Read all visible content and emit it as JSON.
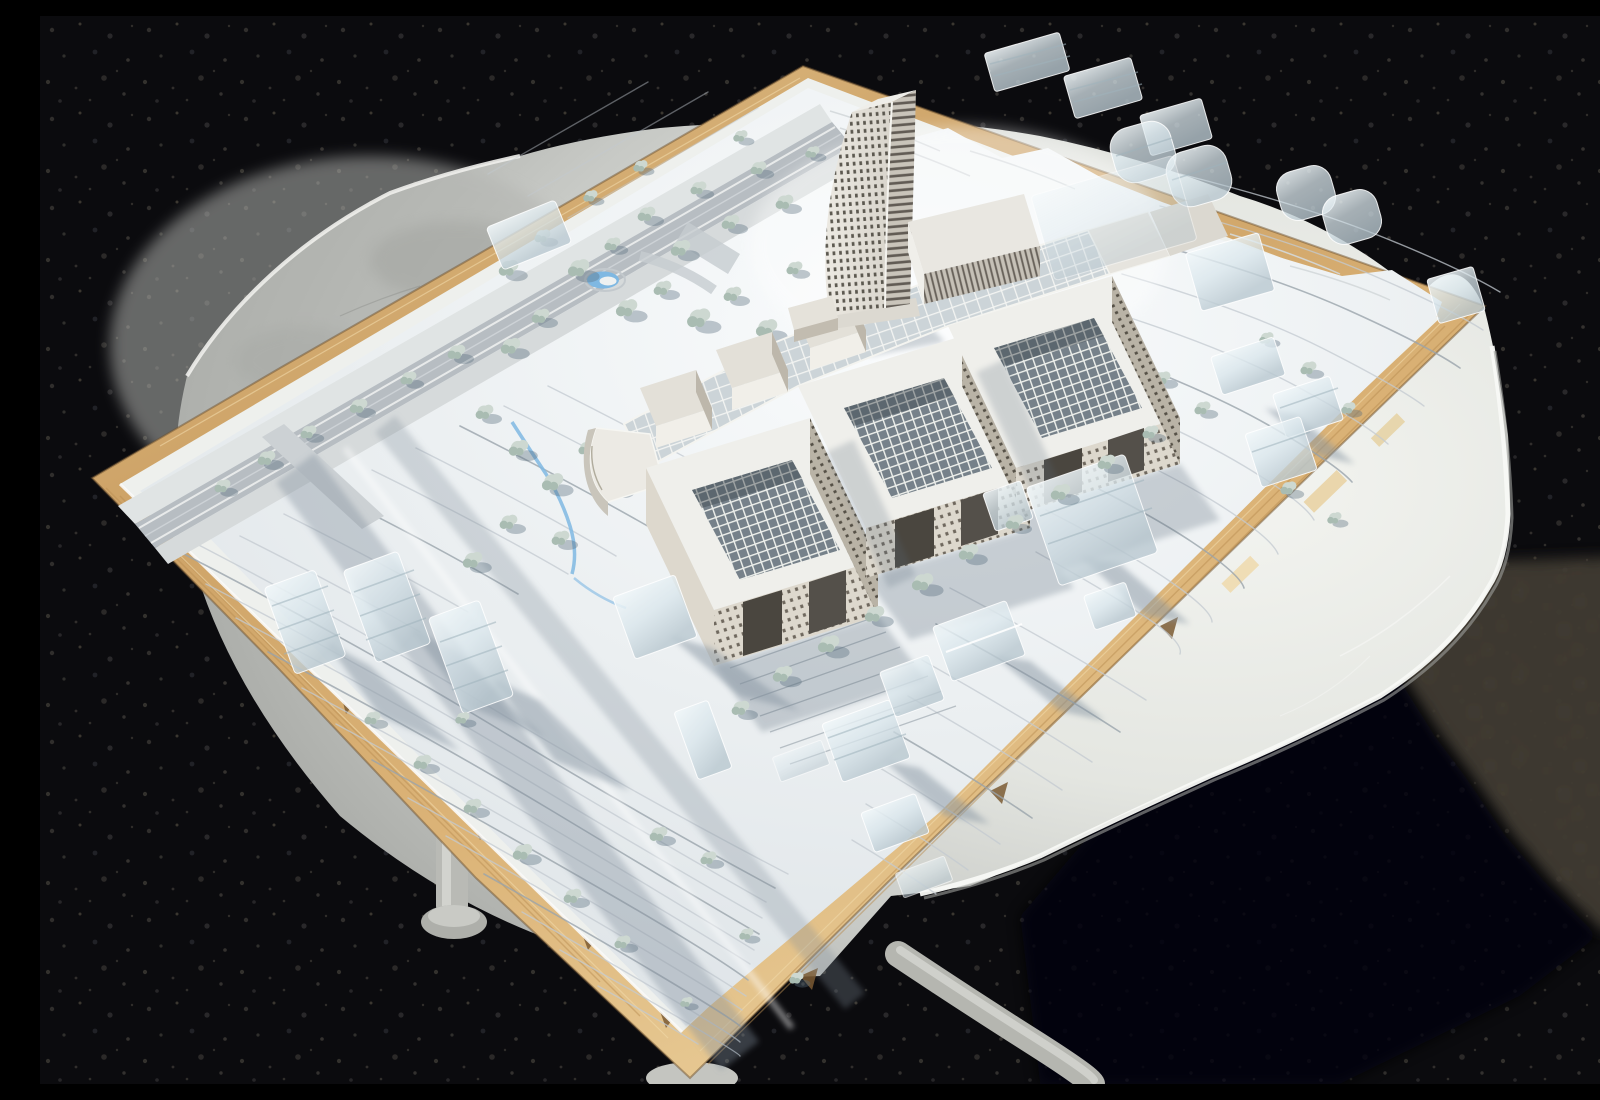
{
  "scene": {
    "type": "outdoor photograph",
    "description": "White architectural scale model of a campus master plan with a curved high-rise tower and three courtyard blocks, built on a plywood baseboard resting on a round white table over dark asphalt in bright sunlight",
    "setting": "dark asphalt ground, strong sun from upper left, hard shadows",
    "model_board": "rectangular plywood base, rotated diagonally, rough torn edges",
    "table": "round white plastic table with tubular metal legs",
    "lighting": "sunlit asphalt patch at mid right, table shadow lower right"
  },
  "inventory": {
    "tower": "curved tapering high-rise with gridded window facade and louvered side",
    "courtyard_blocks": 3,
    "glass_spine": "long glazed gallery linking the courtyard blocks",
    "auditorium_halls": 3,
    "d_shaped_building": 1,
    "wedge_annex": 1,
    "acrylic_context_buildings": 22,
    "trees": "about 70 small model trees",
    "water_features": "round pond with crescent pool and thin stream",
    "roads": "perimeter road with crossing and two sloped access bands",
    "table_legs_visible": 3
  },
  "palette": {
    "asphalt": "#0b0b0e",
    "asphaltLit": "#3f3a33",
    "table": "#c9cbc7",
    "tableLit": "#f2f3ef",
    "rim": "#f8f9f5",
    "legs": "#c6c7c2",
    "wood": "#d8a768",
    "woodLight": "#ecca92",
    "woodDark": "#9c7442",
    "foam": "#eef0ed",
    "terrain": "#e9edef",
    "contour": "#c3cad0",
    "road": "#b7bdc2",
    "sidewalk": "#e0e4e4",
    "shadow": "#5a6a7a",
    "water": "#7fb8e2",
    "tree1": "#cdd8d1",
    "tree2": "#a9bcb2",
    "tshadow": "rgba(90,110,125,0.38)",
    "wall": "#ddd8cd",
    "wallShade": "#b9b3a6",
    "win": "#5c554a",
    "roof": "#efefeb",
    "glass": "#ccd4d8",
    "skylight": "#76818a"
  }
}
